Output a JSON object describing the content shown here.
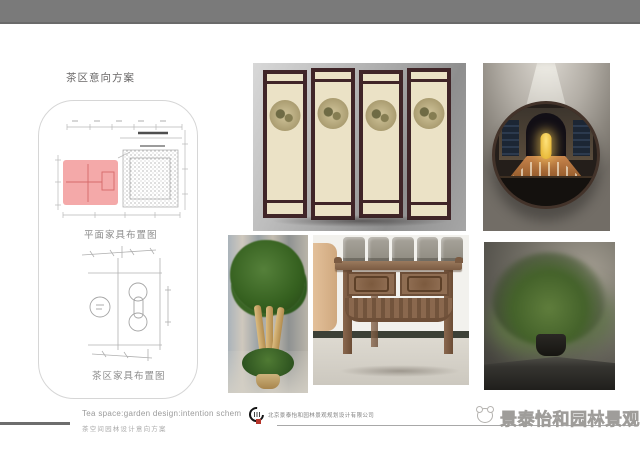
{
  "slide": {
    "title": "茶区意向方案",
    "plans": {
      "top_label": "平面家具布置图",
      "bottom_label": "茶区家具布置图"
    }
  },
  "footer": {
    "subtitle_en": "Tea space:garden design:intention schem",
    "subtitle_cn": "茶空间园林设计意向方案",
    "company_name": "北京景泰怡和园林景观规划设计有限公司",
    "watermark_text": "景泰怡和园林景观"
  },
  "colors": {
    "top_bar": "#7a7a7a",
    "plan_highlight": "#f29d9d",
    "screen_frame": "#402528",
    "logo_red": "#b5342a"
  }
}
